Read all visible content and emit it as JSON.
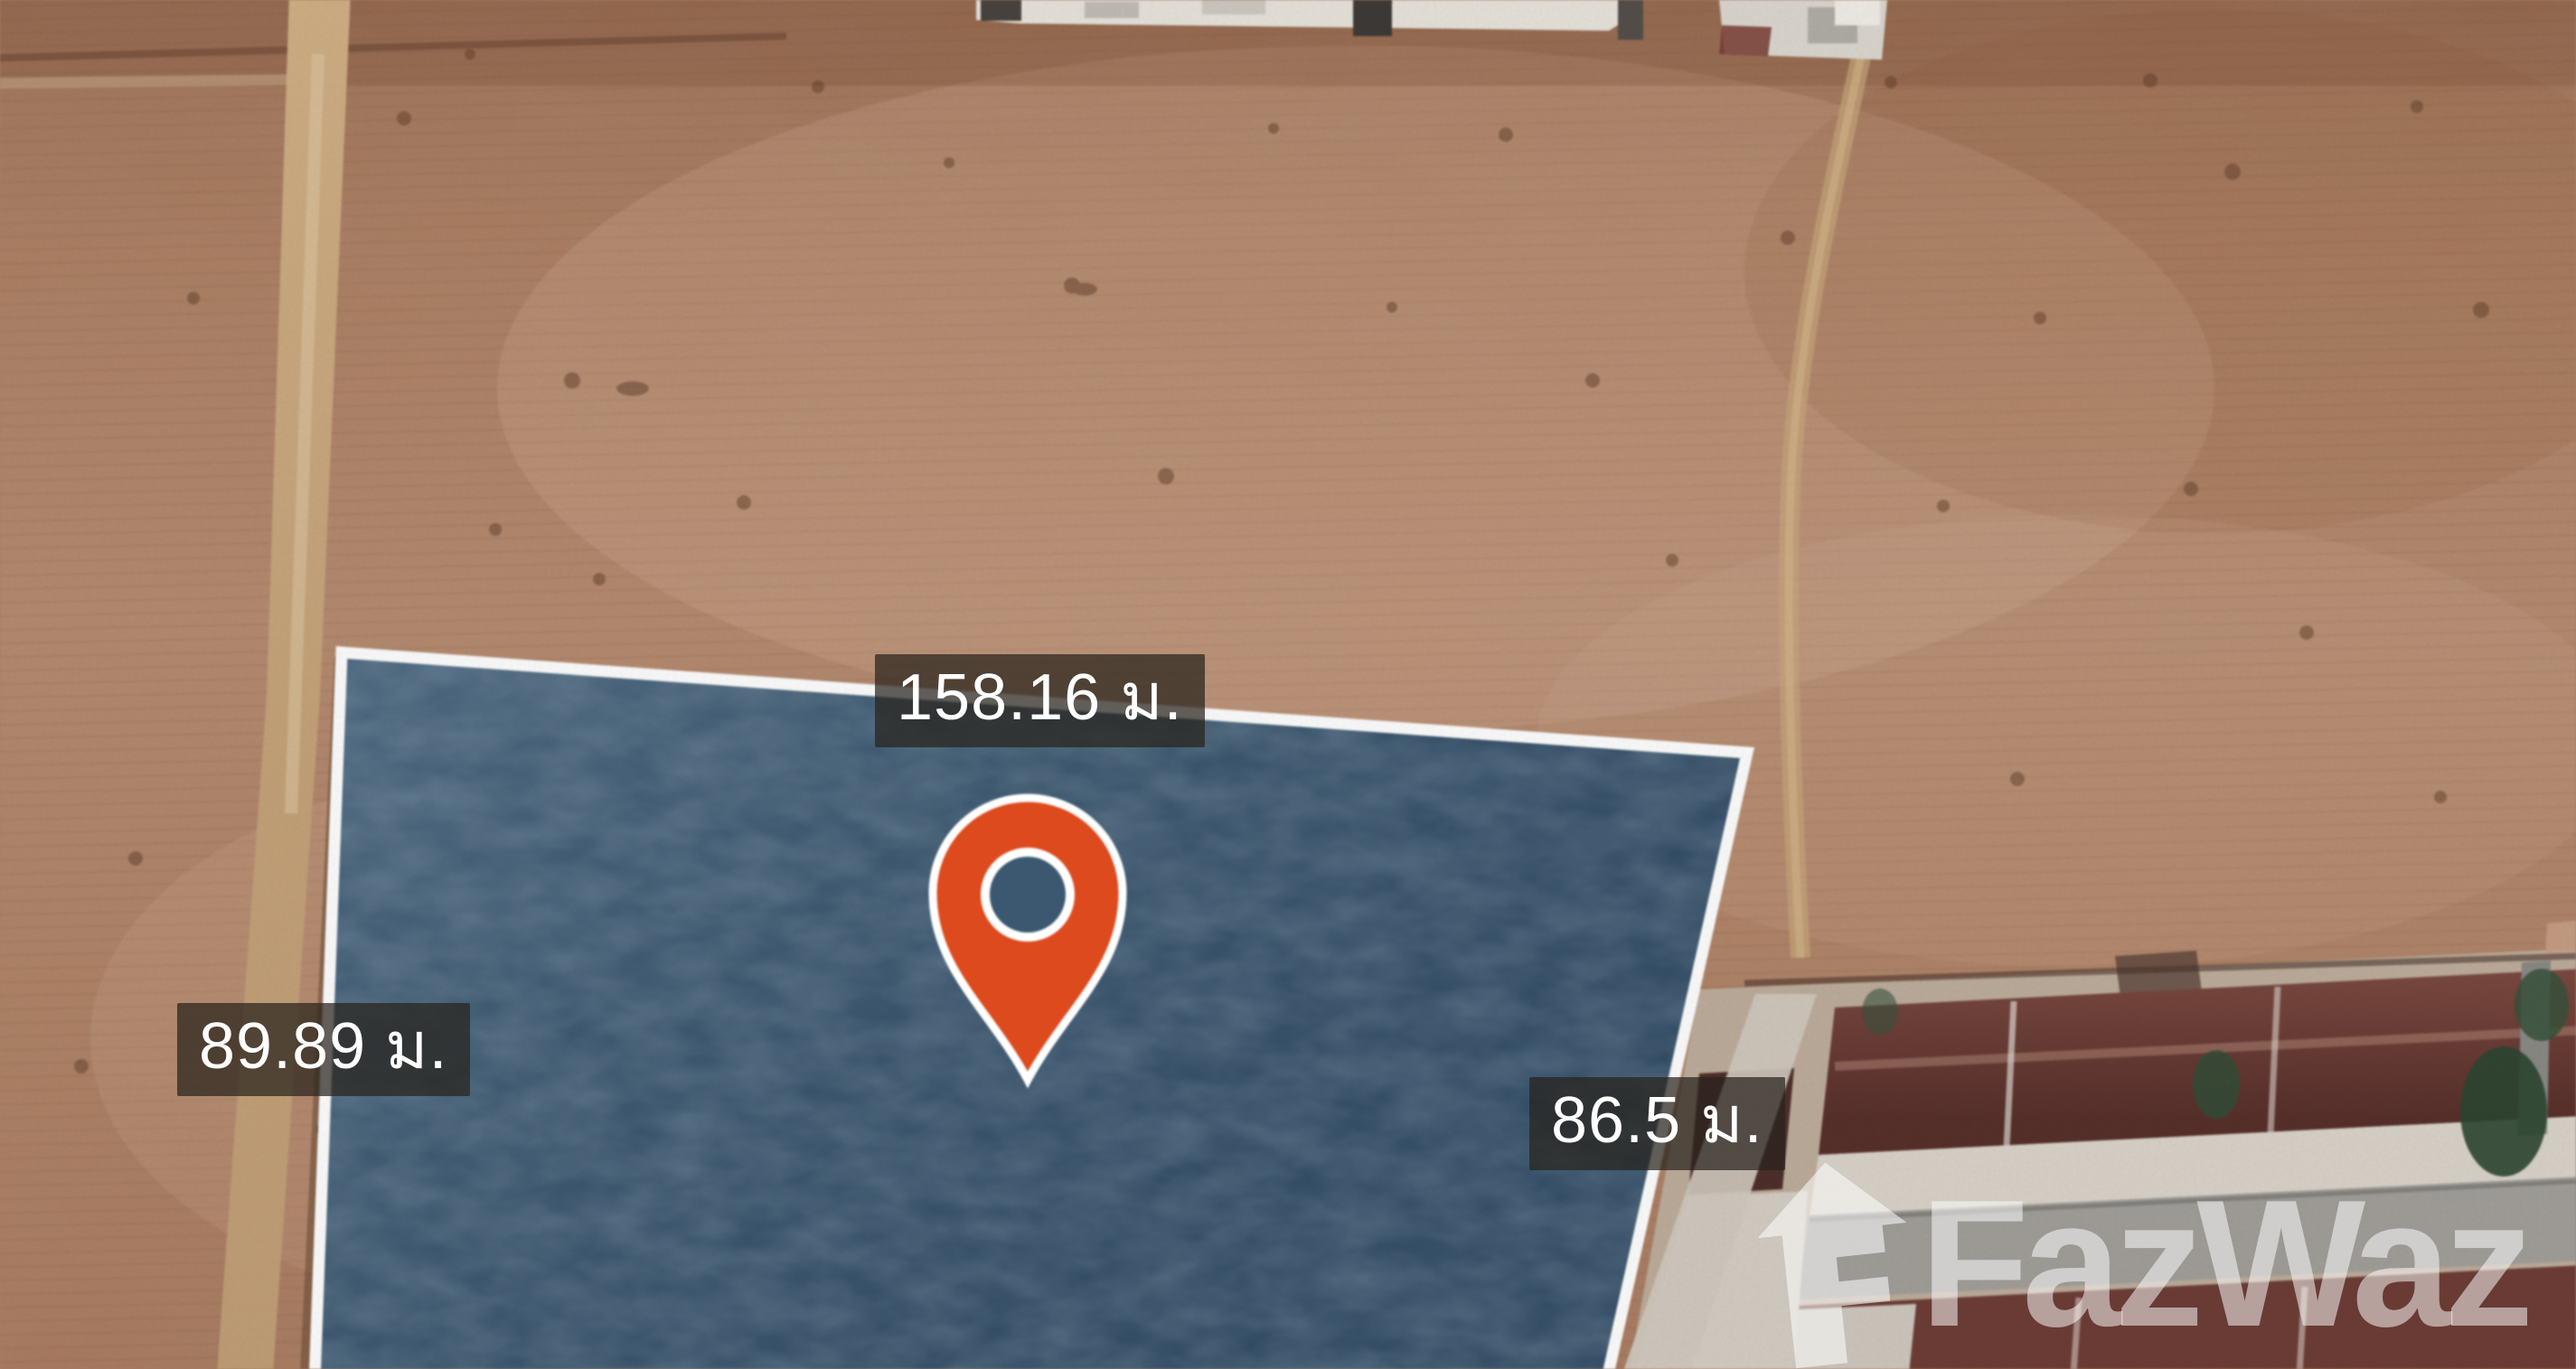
{
  "map_overlay": {
    "dimension_labels": {
      "top": "158.16 ม.",
      "left": "89.89 ม.",
      "right": "86.5 ม."
    },
    "label_background": "rgba(40,34,28,0.72)",
    "label_text_color": "#ffffff",
    "plot": {
      "fill_color": "#3e5a72",
      "border_color": "#ffffff"
    },
    "marker": {
      "icon": "map-pin-icon",
      "color": "#dc4a1d"
    }
  },
  "watermark": {
    "brand": "FazWaz",
    "icon": "house-icon",
    "color": "rgba(255,255,255,0.52)"
  },
  "scene_colors": {
    "field_brown": "#b2846a",
    "dirt_road_tan": "#c9a87d",
    "roof_maroon": "#6e3e37",
    "street_gray": "#a3a09b"
  }
}
